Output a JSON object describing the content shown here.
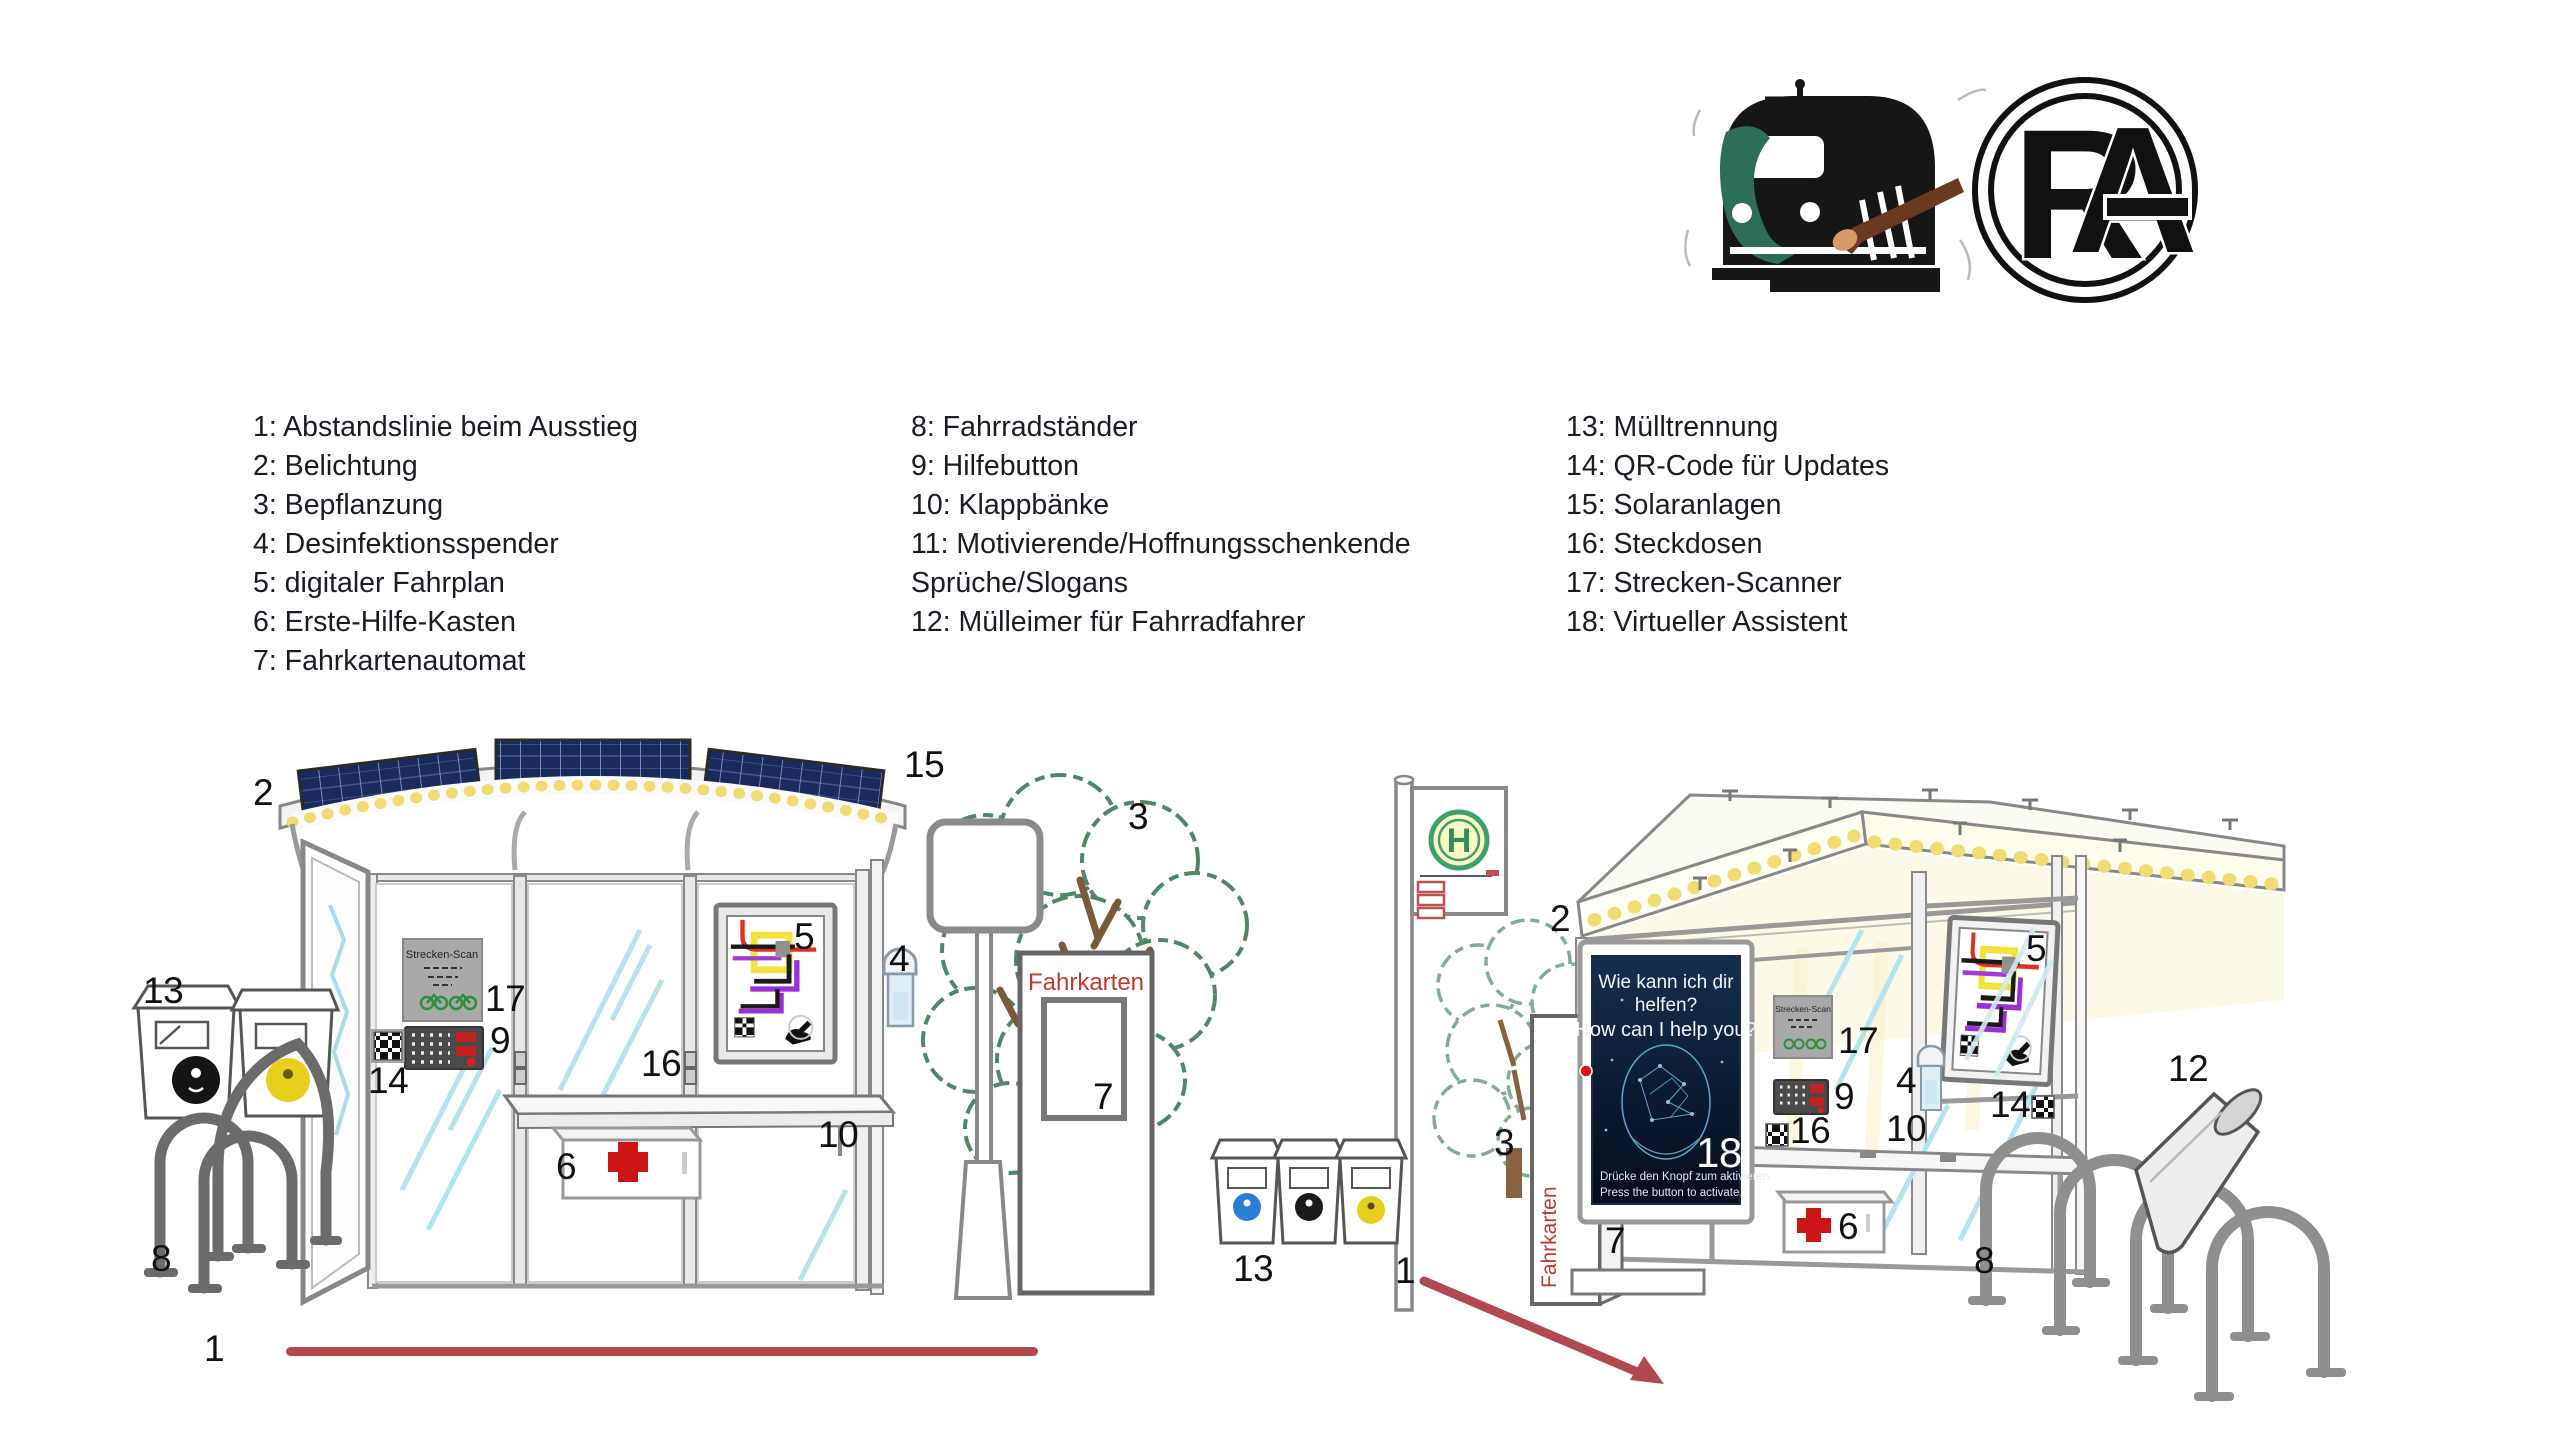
{
  "logos": {
    "train": {
      "name": "train-paintbrush-logo",
      "body_color": "#161616",
      "swoosh_color": "#2c6e57",
      "brush_color": "#6a3a20",
      "brush_tip_color": "#d79a6c"
    },
    "rag": {
      "letter_r": "R",
      "letter_a": "A",
      "color": "#111111"
    }
  },
  "legend": {
    "text_color": "#1b1b26",
    "columns": [
      {
        "items": [
          "1: Abstandslinie beim Ausstieg",
          "2: Belichtung",
          "3: Bepflanzung",
          "4: Desinfektionsspender",
          "5: digitaler Fahrplan",
          "6: Erste-Hilfe-Kasten",
          "7: Fahrkartenautomat"
        ]
      },
      {
        "items": [
          "8: Fahrradständer",
          "9: Hilfebutton",
          "10: Klappbänke",
          "11: Motivierende/Hoffnungsschenkende Sprüche/Slogans",
          "12: Mülleimer für Fahrradfahrer"
        ]
      },
      {
        "items": [
          "13: Mülltrennung",
          "14: QR-Code für Updates",
          "15: Solaranlagen",
          "16: Steckdosen",
          "17: Strecken-Scanner",
          "18: Virtueller Assistent"
        ]
      }
    ]
  },
  "scene_left": {
    "ticket_machine_text": "Fahrkarten",
    "scanner_title": "Strecken-Scan"
  },
  "scene_right": {
    "ticket_machine_text": "Fahrkarten",
    "scanner_title": "Strecken-Scan",
    "bus_sign_letter": "H",
    "assistant_screen": {
      "line1": "Wie kann ich dir",
      "line2": "helfen?",
      "line3": "How can I help you?",
      "footer1": "Drücke den Knopf zum aktivieren.",
      "footer2": "Press the button to activate."
    }
  },
  "callouts": {
    "left": [
      "2",
      "15",
      "13",
      "17",
      "9",
      "14",
      "16",
      "5",
      "4",
      "10",
      "6",
      "3",
      "7",
      "8",
      "1"
    ],
    "right": [
      "2",
      "3",
      "13",
      "1",
      "7",
      "18",
      "17",
      "9",
      "16",
      "10",
      "4",
      "14",
      "5",
      "6",
      "12",
      "8"
    ]
  },
  "colors": {
    "distance_line": "#b04a50",
    "solar_panel": "#1b2a5c",
    "light_dots": "#f1dc74",
    "red_accent": "#c0392b",
    "screen_bg": "#0b1a33",
    "face_cyan": "#5fb9dd",
    "tree_green_left": "#4f8767",
    "tree_green_right": "#7fae92",
    "rack_gray": "#6f6f6f"
  }
}
